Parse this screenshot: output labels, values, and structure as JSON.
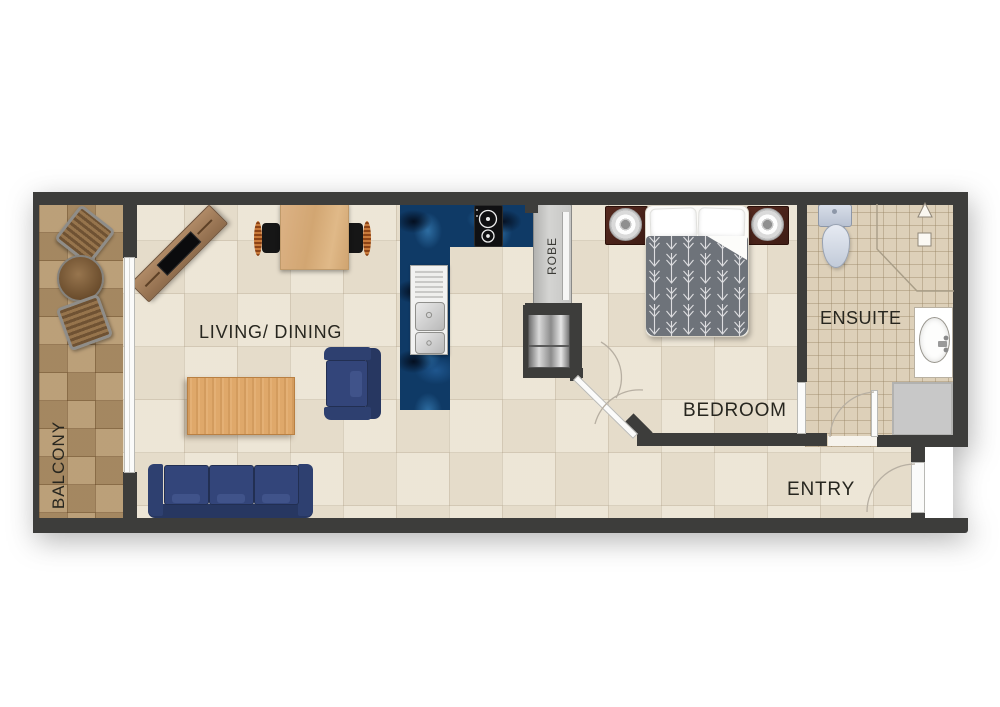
{
  "rooms": {
    "balcony": "BALCONY",
    "living_dining": "LIVING/ DINING",
    "robe": "ROBE",
    "bedroom": "BEDROOM",
    "ensuite": "ENSUITE",
    "entry": "ENTRY"
  },
  "fixtures": [
    "balcony-stool",
    "balcony-round-table",
    "sliding-glass-door",
    "tv-unit",
    "dining-table",
    "dining-chair",
    "coffee-table",
    "armchair",
    "sofa",
    "kitchen-counter",
    "cooktop",
    "double-sink",
    "wardrobe",
    "refrigerator",
    "double-bed",
    "pillow",
    "nightstand",
    "bedside-lamp",
    "bedroom-door",
    "toilet",
    "shower-enclosure",
    "shower-head-symbol",
    "soap-niche-symbol",
    "vanity-basin",
    "laundry-appliance-space",
    "ensuite-door",
    "entry-door"
  ],
  "colors": {
    "wall": "#3d3d3b",
    "floor_main": "#ebe3d3",
    "floor_balcony": "#b3966e",
    "floor_ensuite": "#ddd0b9",
    "counter_marble_blue": "#0f3a66",
    "sofa_navy": "#2e3e6b",
    "wood_light": "#d9b183",
    "wood_coffee": "#dfa86a",
    "wood_dark": "#8a6a48",
    "nightstand_brown": "#4a241c",
    "duvet_grey": "#6e737a"
  }
}
